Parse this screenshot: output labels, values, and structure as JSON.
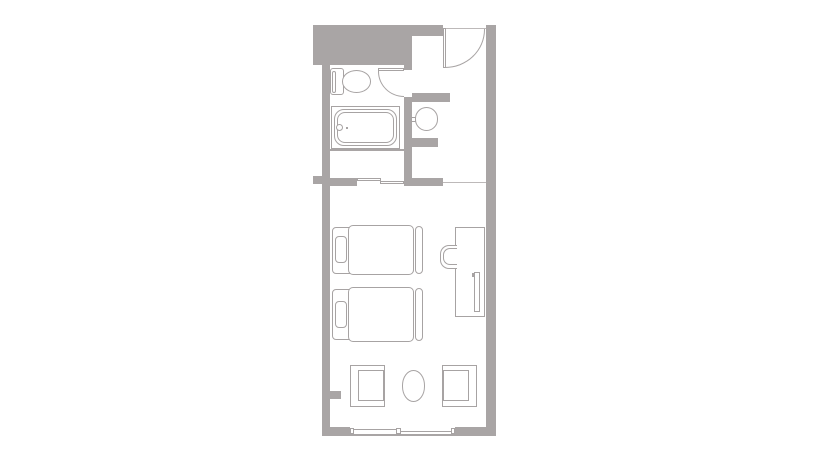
{
  "plan": {
    "title": "Twin hotel room floor plan",
    "colors": {
      "bg": "#ffffff",
      "wall": "#a9a5a5",
      "line": "#a7a3a3",
      "line_soft": "#bdb9b9"
    },
    "rooms": {
      "bathroom": "Unit bathroom",
      "entry": "Entry corridor",
      "closet": "Closet",
      "bedroom": "Bedroom"
    },
    "fixtures": {
      "entrance_door": "Entrance door",
      "bathroom_door": "Bathroom door",
      "toilet": "Toilet",
      "bathtub": "Bathtub",
      "washbasin": "Washbasin",
      "closet_doors": "Closet sliding doors",
      "bed_1": "Twin bed 1",
      "bed_2": "Twin bed 2",
      "pillow_1": "Pillow",
      "pillow_2": "Pillow",
      "desk": "Desk counter",
      "tv": "Television",
      "desk_chair": "Desk chair",
      "armchair_left": "Armchair",
      "armchair_right": "Armchair",
      "coffee_table": "Oval table",
      "window": "Sliding window"
    }
  }
}
